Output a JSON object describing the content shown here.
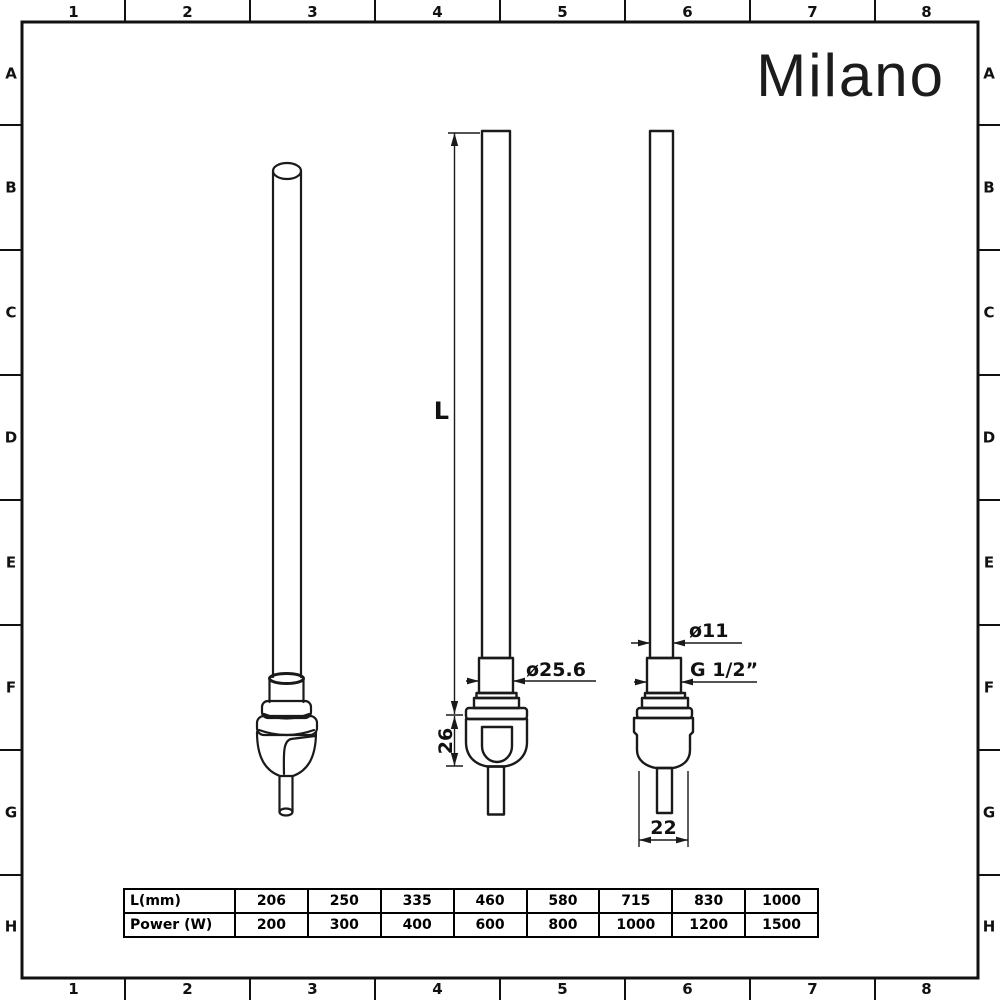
{
  "logo": {
    "text": "Milano"
  },
  "frame": {
    "columns": [
      "1",
      "2",
      "3",
      "4",
      "5",
      "6",
      "7",
      "8"
    ],
    "rows": [
      "A",
      "B",
      "C",
      "D",
      "E",
      "F",
      "G",
      "H"
    ]
  },
  "dimensions": {
    "length": "L",
    "body_height": "26",
    "collar_diameter": "ø25.6",
    "tube_diameter": "ø11",
    "thread": "G 1/2”",
    "body_width": "22"
  },
  "table": {
    "rows": [
      {
        "label": "L(mm)",
        "values": [
          "206",
          "250",
          "335",
          "460",
          "580",
          "715",
          "830",
          "1000"
        ]
      },
      {
        "label": "Power (W)",
        "values": [
          "200",
          "300",
          "400",
          "600",
          "800",
          "1000",
          "1200",
          "1500"
        ]
      }
    ]
  },
  "colors": {
    "line": "#1a1a1a",
    "background": "#ffffff"
  }
}
